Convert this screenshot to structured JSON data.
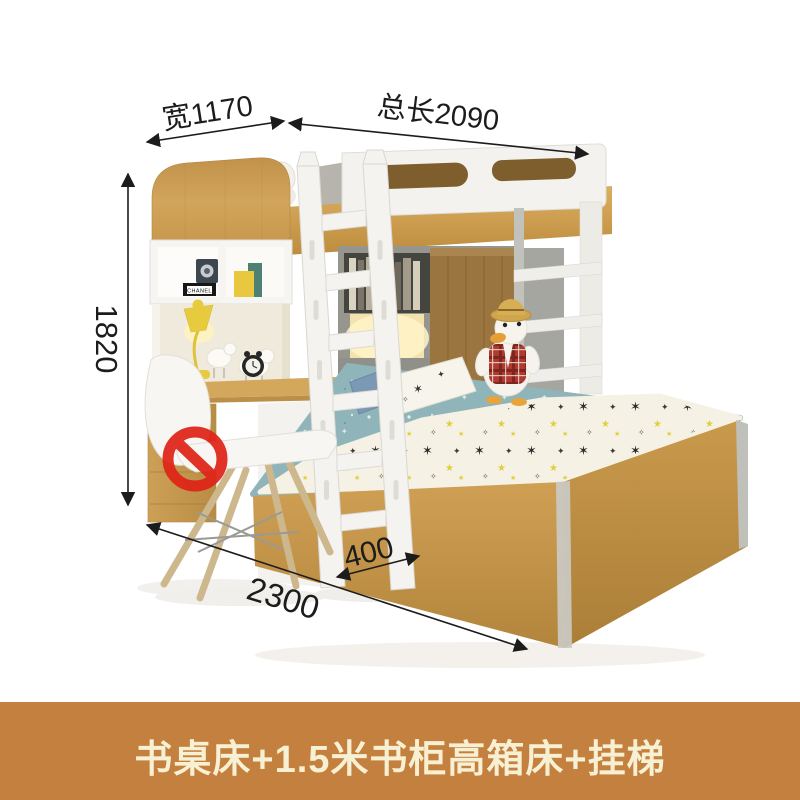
{
  "theme": {
    "background": "#ffffff",
    "banner_bg": "#c4803f",
    "banner_text": "#f8f0d3",
    "dimension_line": "#1c1c1c",
    "prohibition_red": "#e02418",
    "wood": "#cfa057",
    "bedding_teal": "#8fb5ba"
  },
  "caption": {
    "text": "书桌床+1.5米书柜高箱床+挂梯"
  },
  "dimensions": {
    "width_top": {
      "label": "宽1170"
    },
    "length_top": {
      "label": "总长2090"
    },
    "height_left": {
      "label": "1820"
    },
    "ladder_depth": {
      "label": "400"
    },
    "floor_length": {
      "label": "2300"
    }
  },
  "decor": {
    "book_label": "CHANEL"
  }
}
